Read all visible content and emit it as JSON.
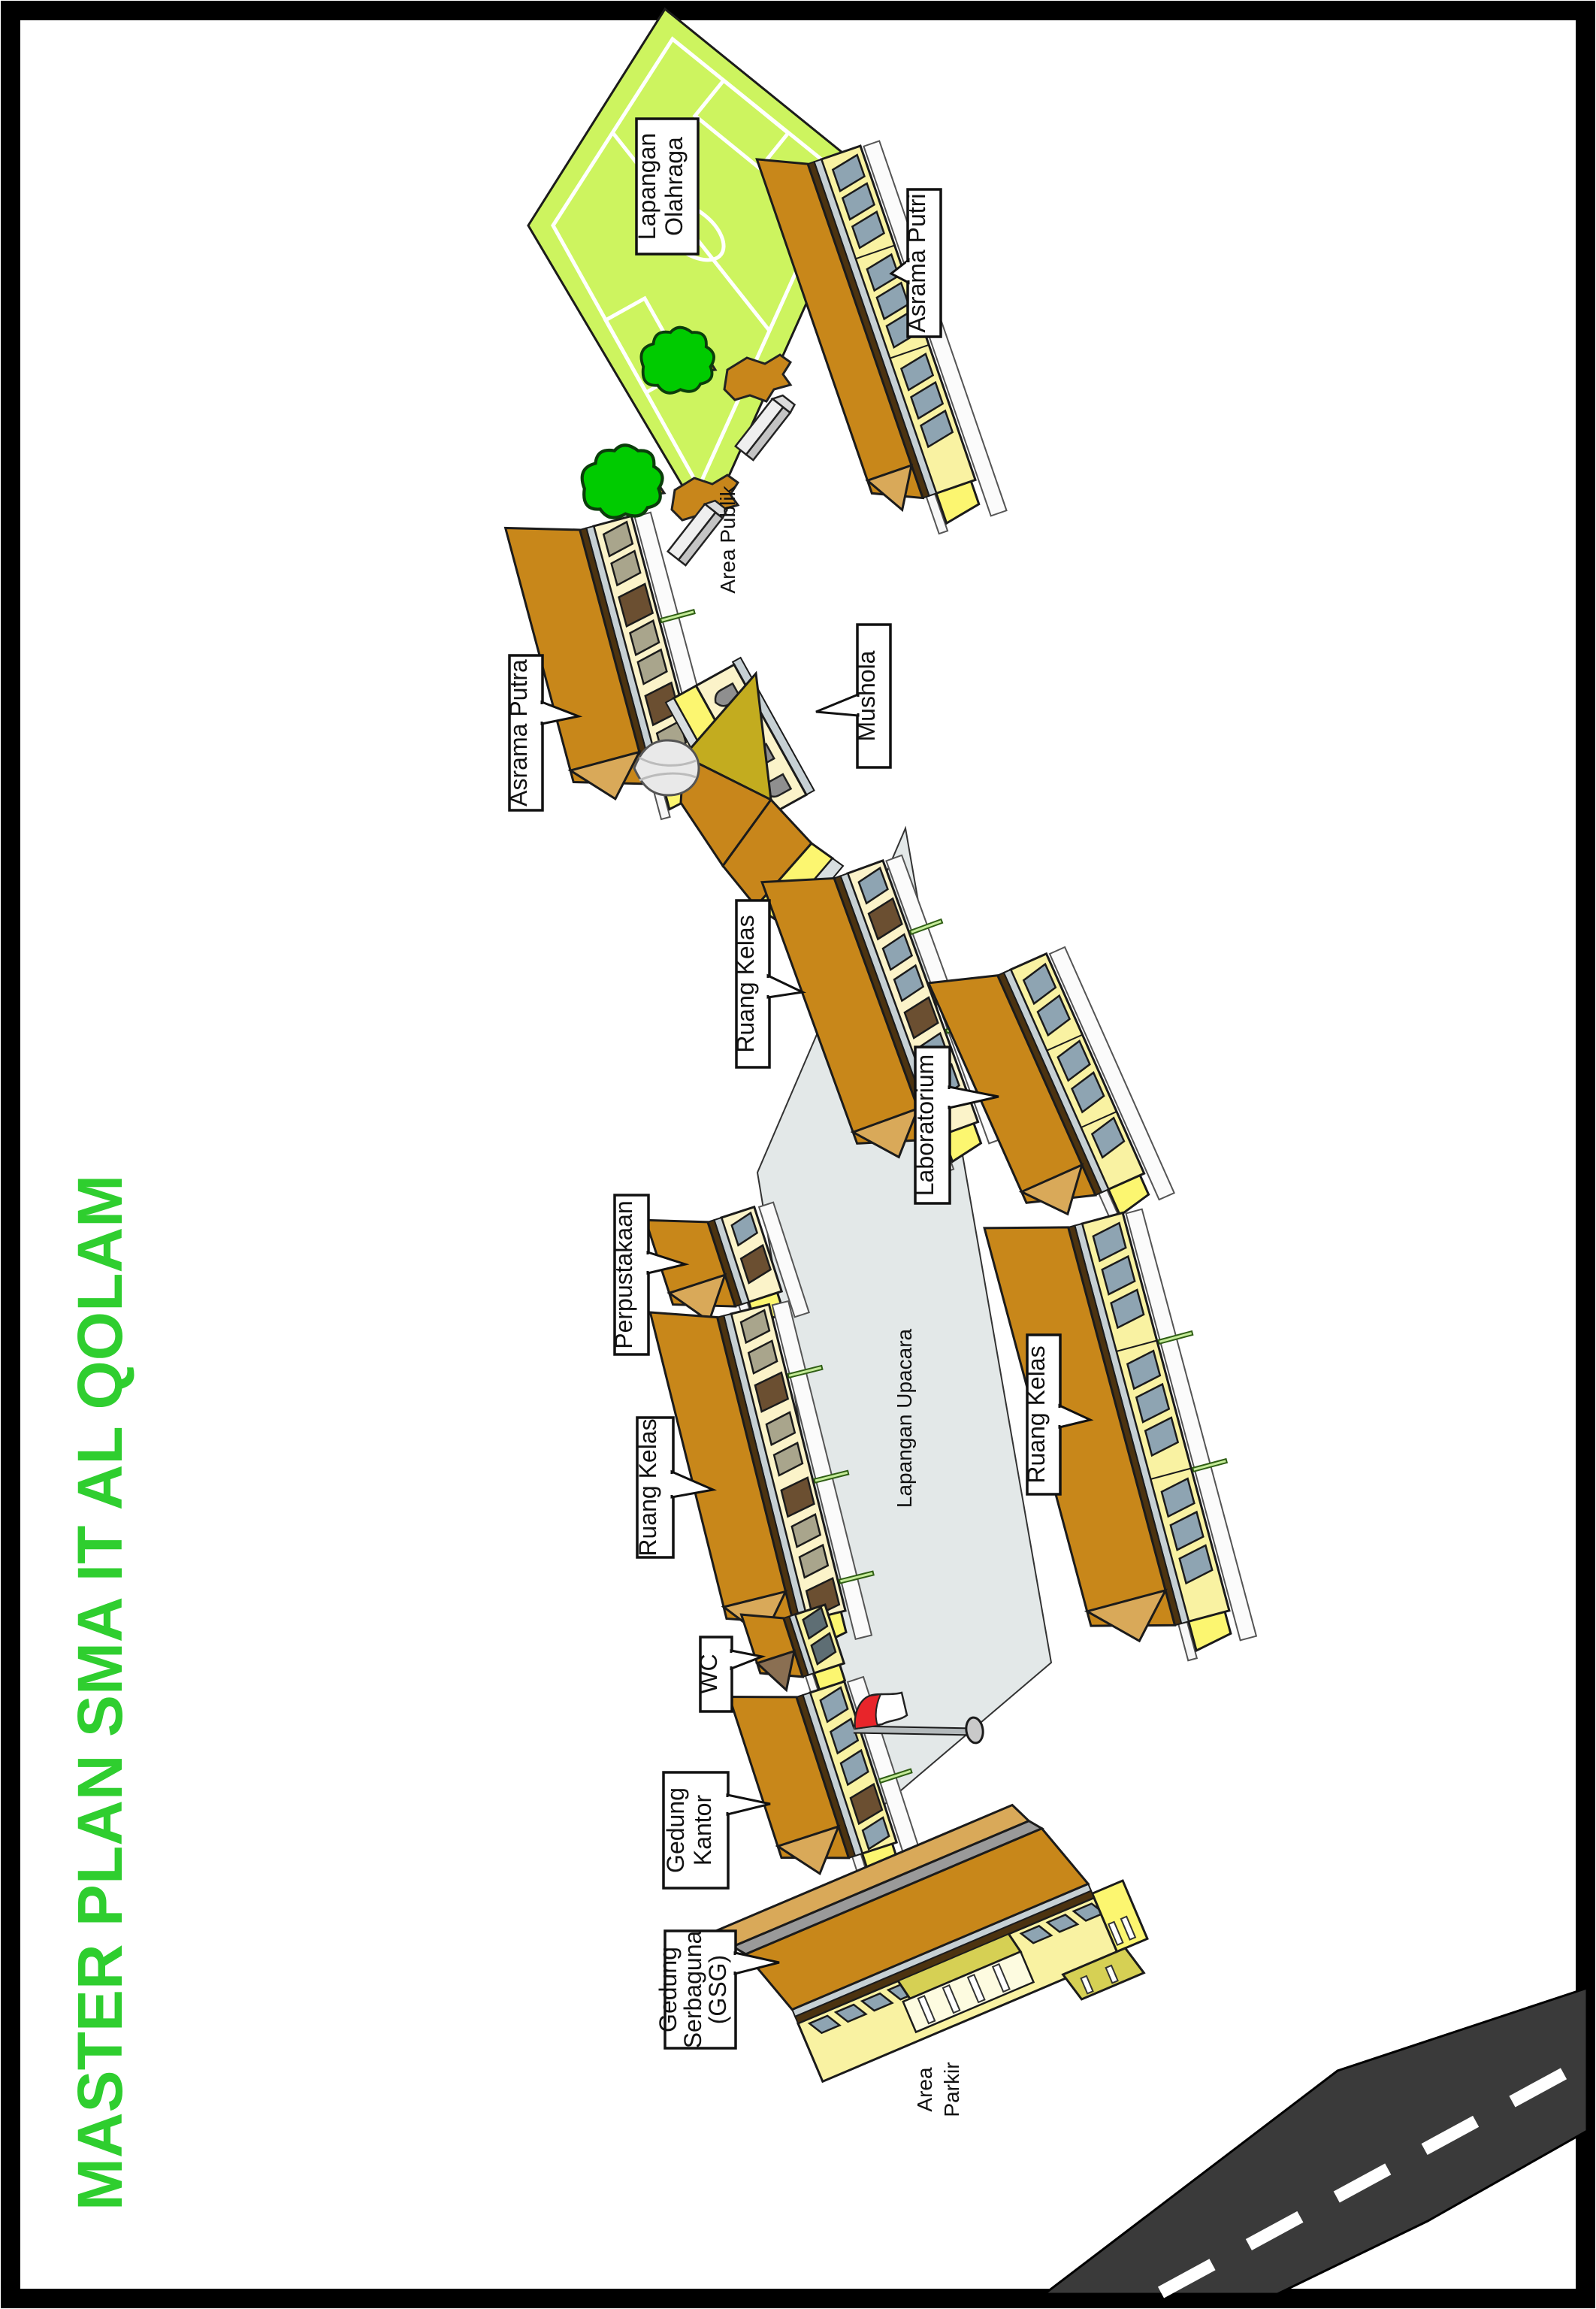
{
  "title": {
    "text": "MASTER PLAN SMA IT AL QOLAM",
    "color": "#2FCE2F"
  },
  "labels": {
    "lapangan_olahraga": {
      "line1": "Lapangan",
      "line2": "Olahraga"
    },
    "asrama_putri": "Asrama Putri",
    "area_publik": "Area Publik",
    "asrama_putra": "Asrama Putra",
    "mushola": "Mushola",
    "ruang_kelas_1": "Ruang Kelas",
    "laboratorium": "Laboratorium",
    "perpustakaan": "Perpustakaan",
    "lapangan_upacara": "Lapangan Upacara",
    "ruang_kelas_2": "Ruang Kelas",
    "ruang_kelas_3": "Ruang Kelas",
    "wc": "WC",
    "gedung_kantor": {
      "line1": "Gedung",
      "line2": "Kantor"
    },
    "gedung_serbaguna": {
      "line1": "Gedung",
      "line2": "Serbaguna",
      "line3": "(GSG)"
    },
    "area_parkir": {
      "line1": "Area",
      "line2": "Parkir"
    }
  },
  "colors": {
    "title_green": "#2FCE2F",
    "sport_field_green": "#CDF45F",
    "ceremony_field_gray": "#E3E8E8",
    "roof_ochre": "#C8871A",
    "roof_hip_light": "#D9A959",
    "wall_pale_yellow": "#F9F2A2",
    "wall_cream": "#FBF3C9",
    "gable_yellow": "#FCF670",
    "window_gray_blue": "#8EA4B2",
    "window_olive": "#A9A58C",
    "door_brown": "#6B4F31",
    "mosque_gold": "#C3AC1F",
    "porch_olive": "#D6D054",
    "tree_green": "#00CB00",
    "flag_red": "#E8252A",
    "road_dark": "#3A3A3A",
    "border_black": "#000000"
  }
}
